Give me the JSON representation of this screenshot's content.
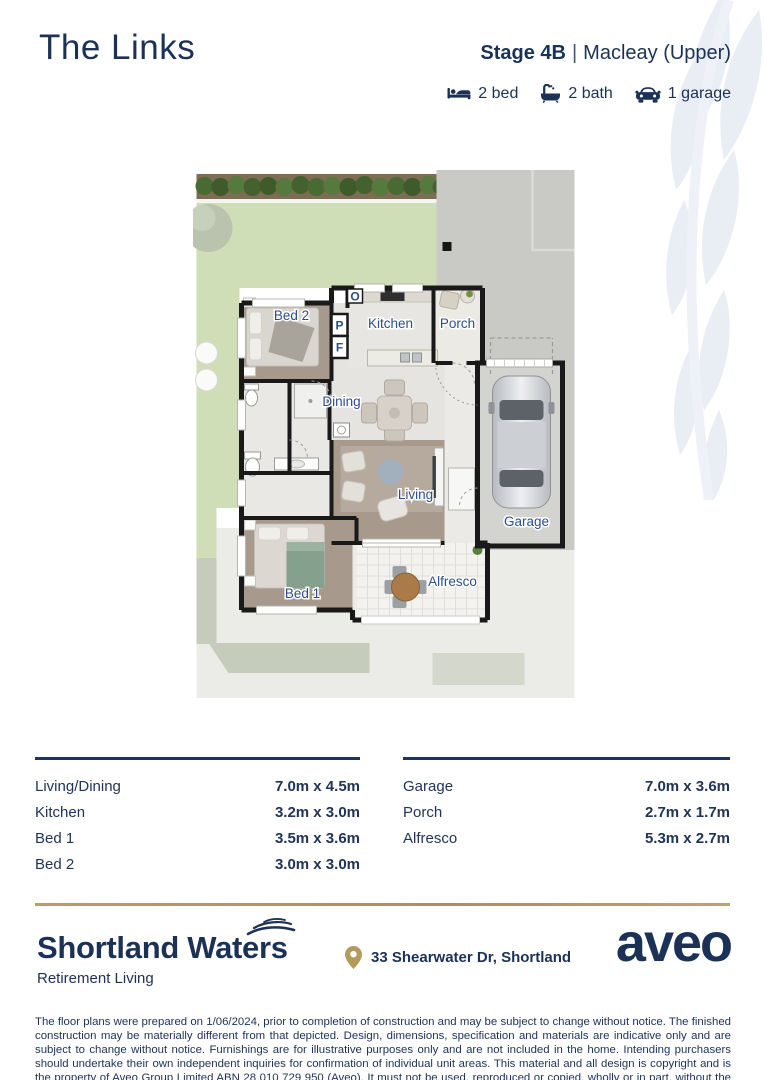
{
  "header": {
    "title": "The Links",
    "stage_label": "Stage 4B",
    "separator": "|",
    "variant": "Macleay (Upper)",
    "features": [
      {
        "icon": "bed-icon",
        "label": "2 bed"
      },
      {
        "icon": "bath-icon",
        "label": "2 bath"
      },
      {
        "icon": "car-icon",
        "label": "1 garage"
      }
    ]
  },
  "floor_plan": {
    "labels": {
      "bed2": "Bed 2",
      "kitchen": "Kitchen",
      "porch": "Porch",
      "dining": "Dining",
      "living": "Living",
      "bed1": "Bed 1",
      "alfresco": "Alfresco",
      "garage": "Garage"
    },
    "markers": {
      "oven": "O",
      "pantry": "P",
      "fridge": "F"
    }
  },
  "dimensions": {
    "left": [
      {
        "room": "Living/Dining",
        "size": "7.0m x 4.5m"
      },
      {
        "room": "Kitchen",
        "size": "3.2m x 3.0m"
      },
      {
        "room": "Bed 1",
        "size": "3.5m x 3.6m"
      },
      {
        "room": "Bed 2",
        "size": "3.0m x 3.0m"
      }
    ],
    "right": [
      {
        "room": "Garage",
        "size": "7.0m x 3.6m"
      },
      {
        "room": "Porch",
        "size": "2.7m x 1.7m"
      },
      {
        "room": "Alfresco",
        "size": "5.3m x 2.7m"
      }
    ]
  },
  "footer": {
    "brand": "Shortland Waters",
    "tagline": "Retirement Living",
    "address": "33 Shearwater Dr, Shortland",
    "logo_text": "aveo",
    "disclaimer": "The floor plans were prepared on 1/06/2024, prior to completion of construction and may be subject to change without notice. The finished construction may be materially different from that depicted. Design, dimensions, specification and materials are indicative only and are subject to change without notice. Furnishings are for illustrative purposes only and are not included in the home. Intending purchasers should undertake their own independent inquiries for confirmation of individual unit areas. This material and all design is copyright and is the property of Aveo Group Limited ABN 28 010 729 950 (Aveo). It must not be used, reproduced or copied, wholly or in part, without the prior written permission of Aveo."
  },
  "colors": {
    "navy": "#1c3156",
    "gold": "#b39b5f",
    "label_blue": "#2d4d89",
    "lawn": "#cfdeb7",
    "driveway": "#c9cac6",
    "floor_taupe": "#a79a8c",
    "floor_tile": "#e5e4e1",
    "garage_floor": "#d3d4d0",
    "wall": "#191919"
  }
}
